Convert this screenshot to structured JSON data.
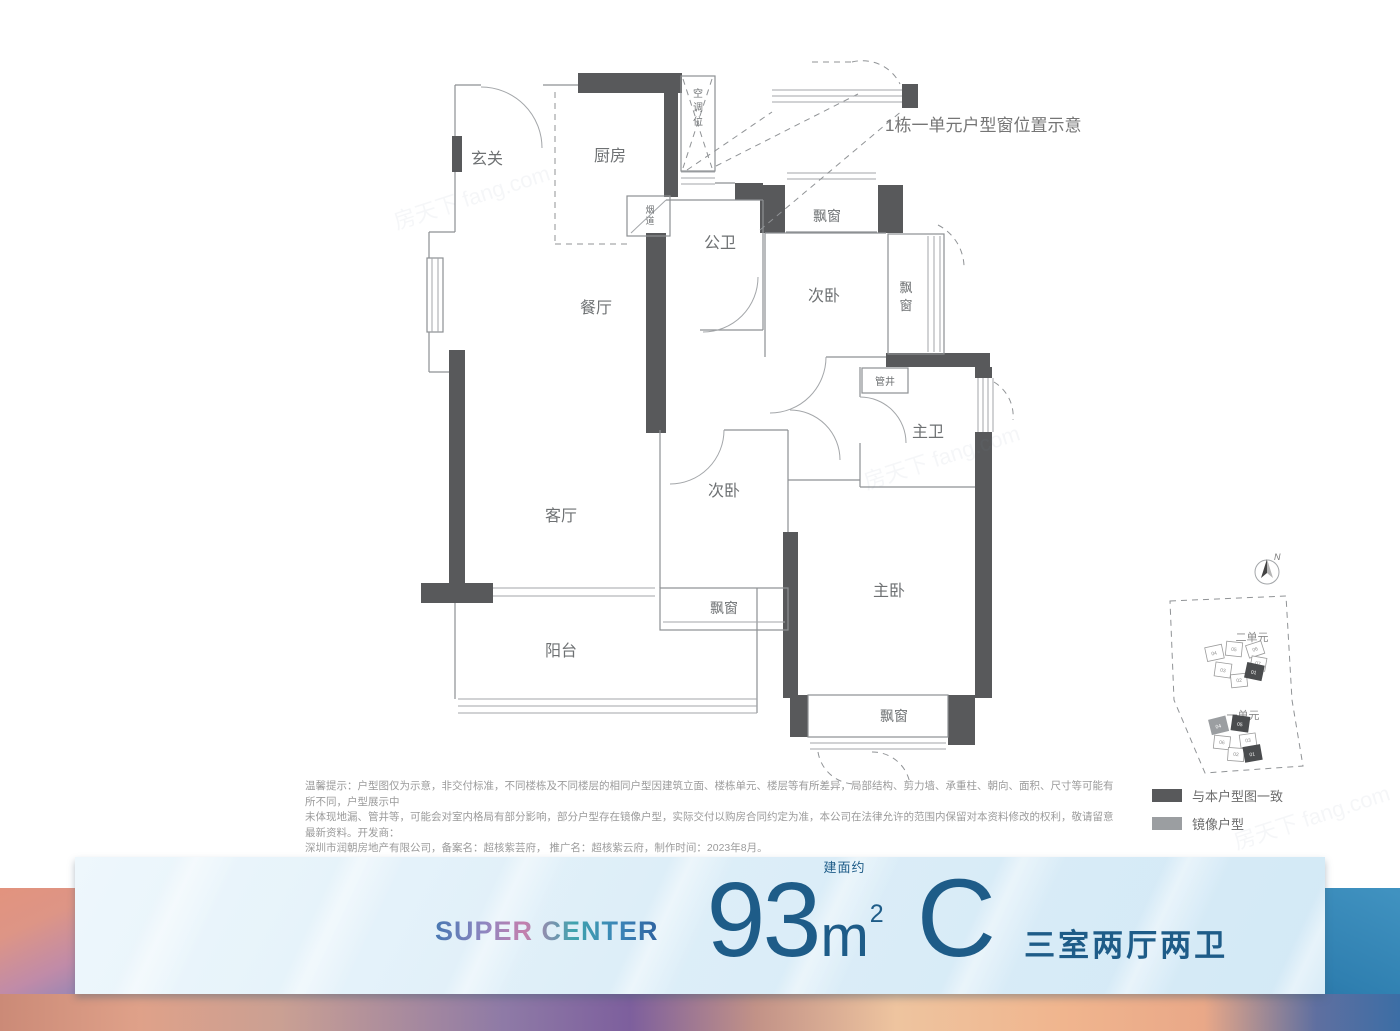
{
  "annotation": {
    "window_position_note": "1栋一单元户型窗位置示意"
  },
  "rooms": {
    "entry": "玄关",
    "kitchen": "厨房",
    "dining": "餐厅",
    "living": "客厅",
    "balcony": "阳台",
    "master_bedroom": "主卧",
    "bedroom2": "次卧",
    "bedroom3": "次卧",
    "public_bath": "公卫",
    "master_bath": "主卫",
    "bay_window": "飘窗",
    "pipe_shaft": "管井",
    "ac_chars": [
      "空",
      "调",
      "位"
    ],
    "flue_chars": [
      "烟",
      "道"
    ],
    "bay_chars": [
      "飘",
      "窗"
    ]
  },
  "sitemap": {
    "north": "N",
    "unit2_label": "二单元",
    "unit1_label": "一单元",
    "unit2_numbers": [
      "04",
      "05",
      "06",
      "07",
      "03",
      "02",
      "01"
    ],
    "unit1_numbers": [
      "04",
      "05",
      "06",
      "03",
      "02",
      "01"
    ]
  },
  "legend": {
    "match": "与本户型图一致",
    "mirror": "镜像户型",
    "match_color": "#58595B",
    "mirror_color": "#9B9EA1"
  },
  "disclaimer": {
    "line1": "温馨提示：户型图仅为示意，非交付标准，不同楼栋及不同楼层的相同户型因建筑立面、楼栋单元、楼层等有所差异，局部结构、剪力墙、承重柱、朝向、面积、尺寸等可能有所不同，户型展示中",
    "line2": "未体现地漏、管井等，可能会对室内格局有部分影响，部分户型存在镜像户型，实际交付以购房合同约定为准，本公司在法律允许的范围内保留对本资料修改的权利，敬请留意最新资料。开发商：",
    "line3": "深圳市润朝房地产有限公司，备案名：超核紫芸府， 推广名：超核紫云府，制作时间：2023年8月。"
  },
  "banner": {
    "brand": "SUPER CENTER",
    "area_number": "93",
    "area_prefix": "建面约",
    "area_unit": "m",
    "area_sup": "2",
    "type_letter": "C",
    "type_desc": "三室两厅两卫",
    "text_color": "#1E5C88"
  },
  "watermark": "房天下 fang.com"
}
